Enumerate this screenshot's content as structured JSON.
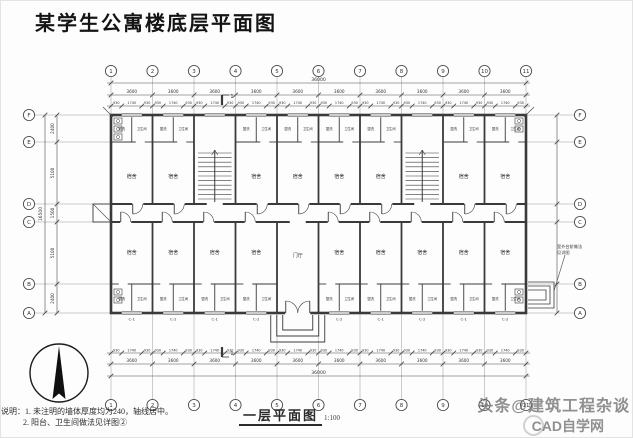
{
  "page": {
    "title": "某学生公寓楼底层平面图",
    "watermark": {
      "line1": "头条@建筑工程杂谈",
      "line2": "CAD自学网",
      "logo": "circle-logo"
    }
  },
  "plan": {
    "caption": "一层平面图",
    "scale": "1:100",
    "notes": [
      "说明：1. 未注明的墙体厚度均为240，轴线居中。",
      "2. 阳台、卫生间做法见详图②"
    ],
    "grid": {
      "top_labels": [
        "1",
        "2",
        "3",
        "4",
        "5",
        "6",
        "7",
        "8",
        "9",
        "10",
        "11"
      ],
      "side_labels": [
        "F",
        "E",
        "D",
        "C",
        "B",
        "A"
      ]
    },
    "dimensions": {
      "overall_length": "36000",
      "bay_width": "3600",
      "window_chain": [
        "930",
        "1740",
        "930"
      ],
      "left_chain": [
        "2400",
        "5100",
        "1500",
        "5100",
        "2400"
      ],
      "overall_width": "16500"
    },
    "rooms": {
      "dorm": "宿舍",
      "wash": "盥洗",
      "bath": "卫生间",
      "hall": "门厅"
    },
    "marks": {
      "window_a": "C-1",
      "window_b": "C-2",
      "section": "1"
    },
    "annotations": {
      "steps_note_1": "室外台阶做法",
      "steps_note_2": "见详图"
    },
    "colors": {
      "ink": "#3a3a3a",
      "dim": "#4c4c4c",
      "text": "#333333"
    }
  }
}
